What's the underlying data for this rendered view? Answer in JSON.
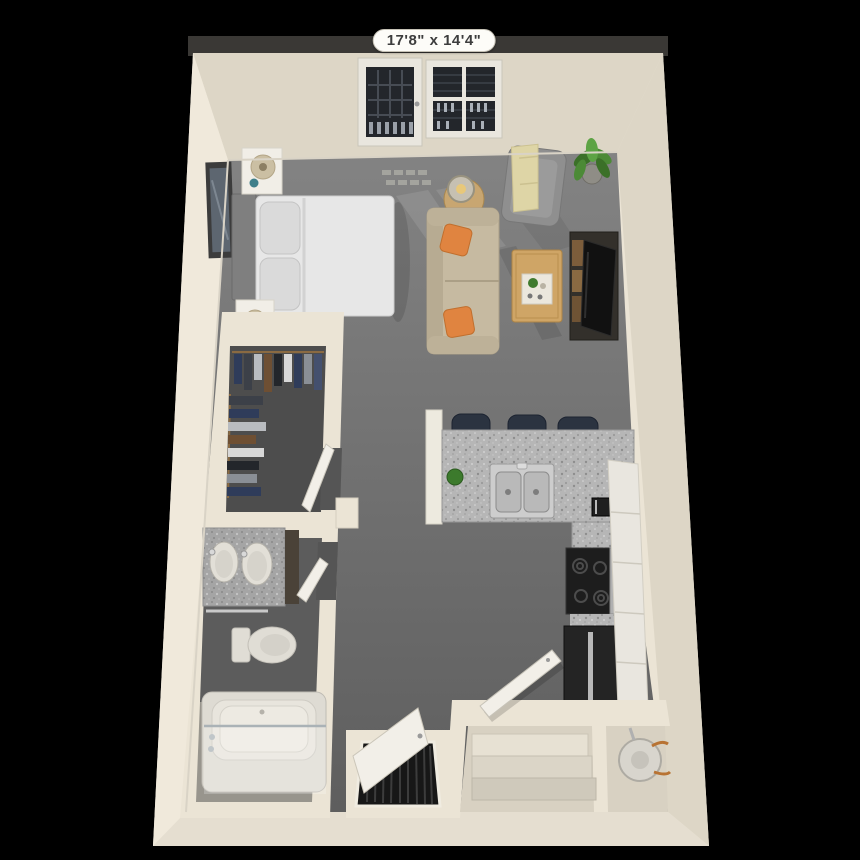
{
  "plan": {
    "dimensions_label": "17'8\" x 14'4\"",
    "unit_type": "studio-floor-plan-3d",
    "palette": {
      "background": "#000000",
      "outer_band": "#3a3835",
      "wall": "#ebe4d5",
      "wall_light": "#f0e9db",
      "wall_dark": "#ddd6c6",
      "wall_bottom": "#e5ded0",
      "floor_hi": "#838383",
      "floor_lo": "#5e5e5e",
      "closet_floor": "#4d4d4d",
      "bath_floor": "#5c5c5c",
      "tile": "#98958d",
      "cabinet": "#e9e6df",
      "counter_cap": "#edeadf",
      "stool": "#2b3340",
      "stove": "#1d1d1d",
      "fridge": "#242424",
      "steel": "#b0b0b0",
      "sofa": "#c6baa1",
      "pillow_orange": "#e08440",
      "armchair": "#8f8f8f",
      "throw_yellow": "#ded5a6",
      "table_wood": "#c8a671",
      "coffee_table_wood": "#cfa566",
      "tv_stand": "#33302b",
      "plant_green": "#4c8a36",
      "bed_white": "#e7e7e7",
      "headboard": "#7f7f7f",
      "nightstand": "#f1eee7",
      "lamp_shade": "#cbbfa3",
      "fixture_white": "#e0ddd5",
      "door_white": "#f2efe8",
      "glass_dark": "#23262b",
      "entry_floor": "#d8d1c2",
      "step": "#e7e1d3",
      "copper": "#b87333",
      "label_bg": "#fdfcf8",
      "label_text": "#3d3d3d"
    },
    "rooms": {
      "bedroom_area": [
        "framed-art",
        "headboard",
        "queen-bed",
        "bed-pillows",
        "nightstand-upper",
        "nightstand-lower",
        "table-lamp",
        "balcony-door",
        "window"
      ],
      "living_area": [
        "sofa",
        "accent-pillow",
        "accent-pillow",
        "armchair",
        "throw-blanket",
        "floor-lamp",
        "side-table",
        "coffee-table",
        "serving-tray",
        "tv-console",
        "tv",
        "potted-plant"
      ],
      "kitchen": [
        "breakfast-bar",
        "bar-stool",
        "bar-stool",
        "bar-stool",
        "double-basin-sink",
        "counter-plant",
        "coffee-maker",
        "range",
        "refrigerator",
        "cabinet-run"
      ],
      "walk_in_closet": [
        "clothes-rod",
        "hanging-clothes",
        "closet-door"
      ],
      "bathroom": [
        "double-vanity",
        "vanity-sink",
        "vanity-sink",
        "towel-bar",
        "toilet",
        "bathtub",
        "glass-shower-panel",
        "bathroom-door"
      ],
      "entry_area": [
        "entry-door",
        "stairs",
        "water-heater",
        "louvered-closet-door"
      ]
    }
  }
}
